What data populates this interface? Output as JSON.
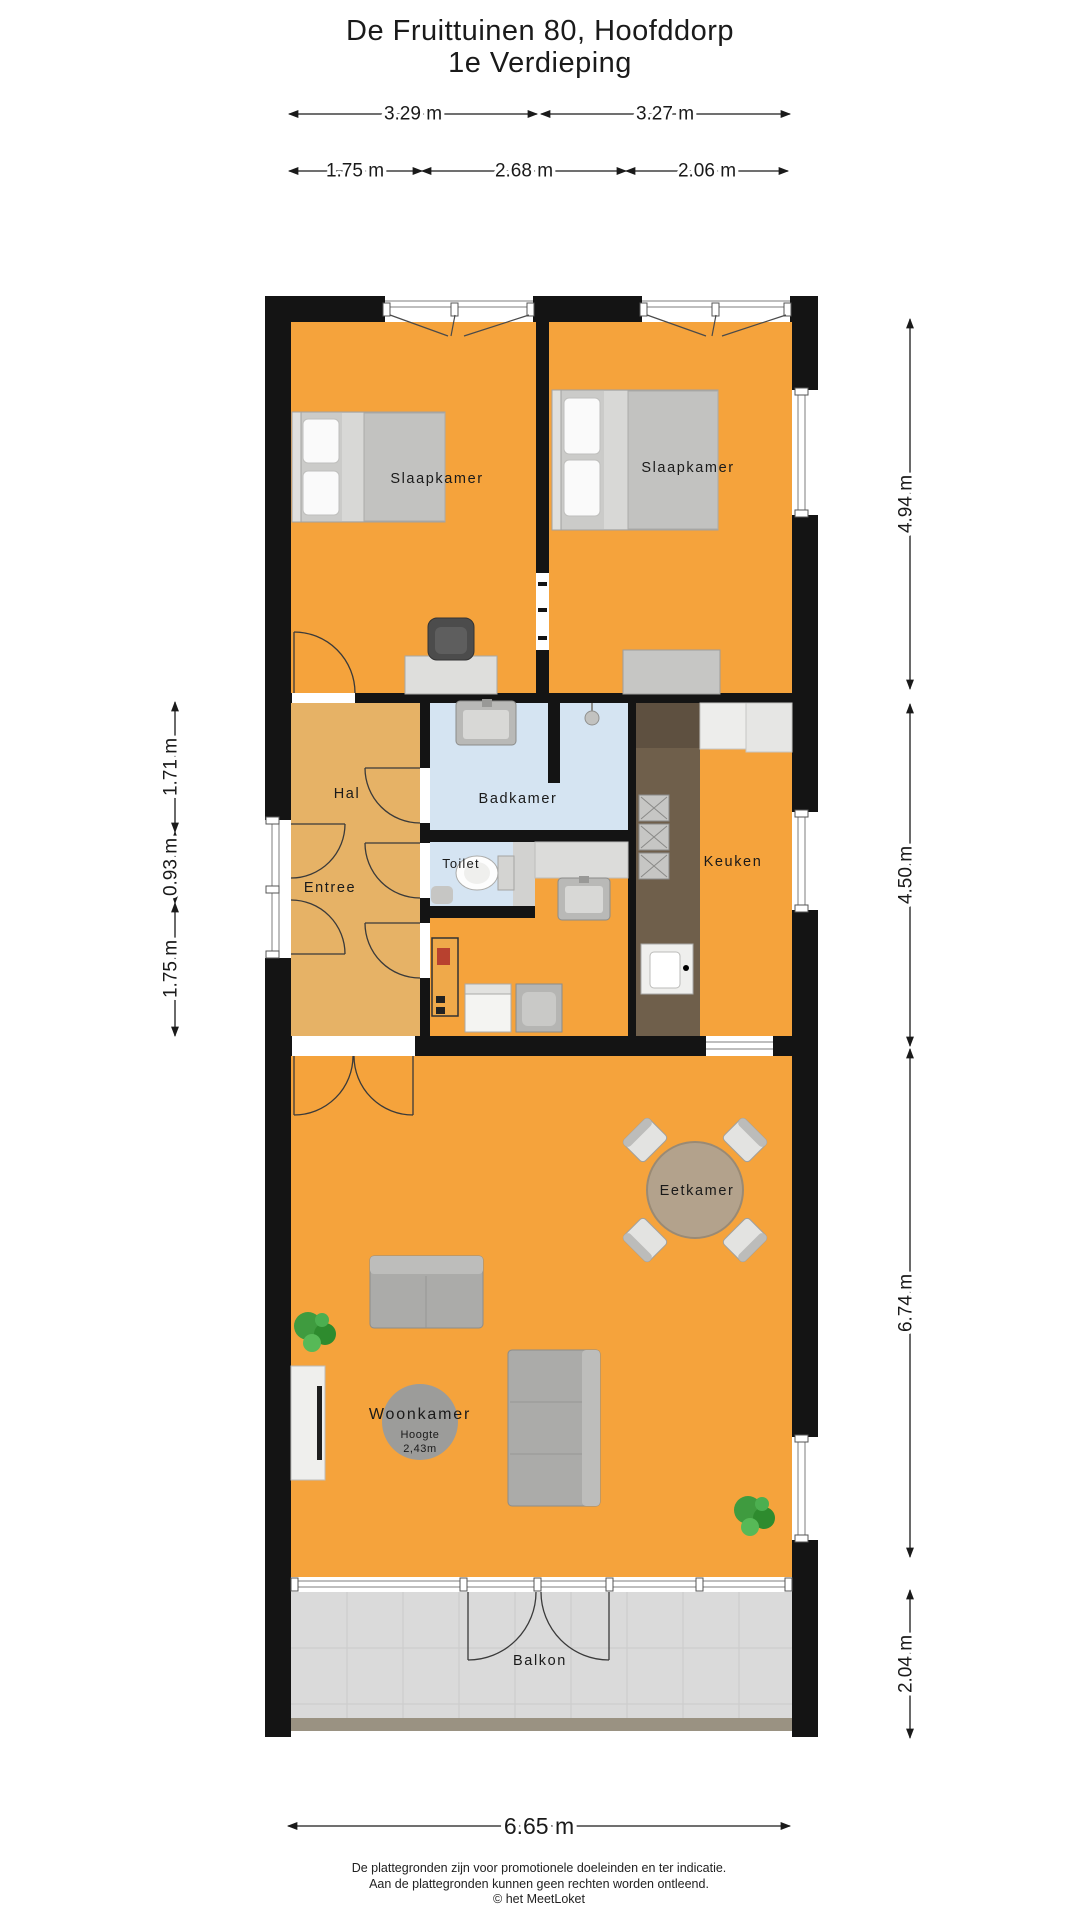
{
  "title": {
    "line1": "De Fruittuinen 80, Hoofddorp",
    "line2": "1e Verdieping"
  },
  "dimensions": {
    "top_row1": [
      "3.29 m",
      "3.27 m"
    ],
    "top_row2": [
      "1.75 m",
      "2.68 m",
      "2.06 m"
    ],
    "left": [
      "1.71 m",
      "0.93 m",
      "1.75 m"
    ],
    "right": [
      "4.94 m",
      "4.50 m",
      "6.74 m",
      "2.04 m"
    ],
    "bottom": "6.65 m"
  },
  "rooms": {
    "slaapkamer_left": "Slaapkamer",
    "slaapkamer_right": "Slaapkamer",
    "hal": "Hal",
    "entree": "Entree",
    "badkamer": "Badkamer",
    "toilet": "Toilet",
    "keuken": "Keuken",
    "eetkamer": "Eetkamer",
    "woonkamer": "Woonkamer",
    "hoogte_label": "Hoogte",
    "hoogte_value": "2,43m",
    "balkon": "Balkon"
  },
  "footer": {
    "line1": "De plattegronden zijn voor promotionele doeleinden en ter indicatie.",
    "line2": "Aan de plattegronden kunnen geen rechten worden ontleend.",
    "line3": "© het MeetLoket"
  },
  "colors": {
    "room_orange": "#F5A33C",
    "hall_tan": "#E6B266",
    "bath_blue": "#D5E4F2",
    "wall_black": "#141414",
    "counter_brown": "#6F5F4B",
    "balcony_gray": "#DADADA",
    "furniture_gray": "#C9C9C7"
  }
}
